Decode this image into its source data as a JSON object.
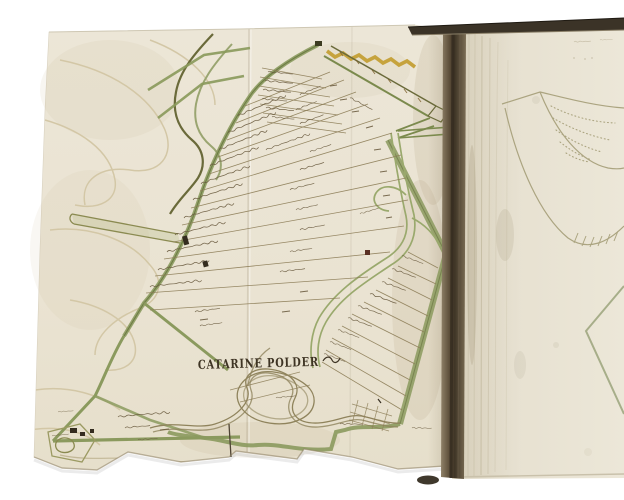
{
  "page": {
    "background_color": "#ffffff"
  },
  "map_sheet": {
    "title": "CATARINE POLDER",
    "paper_color": "#ebe5d5",
    "dike_green": "#8b9a5e",
    "road_green": "#9aa96d",
    "sand_band_yellow": "#c49f35",
    "parcel_ink": "#8d7e58",
    "handwriting_ink": "#6b5c40",
    "title_ink": "#3e3424",
    "river_ink": "#6a6a3a"
  },
  "book": {
    "spine_color": "#5a4c38",
    "top_edge_color": "#3b3327",
    "right_page_color": "#e7e1d1",
    "right_page_sketch_ink": "#a8a17c"
  }
}
